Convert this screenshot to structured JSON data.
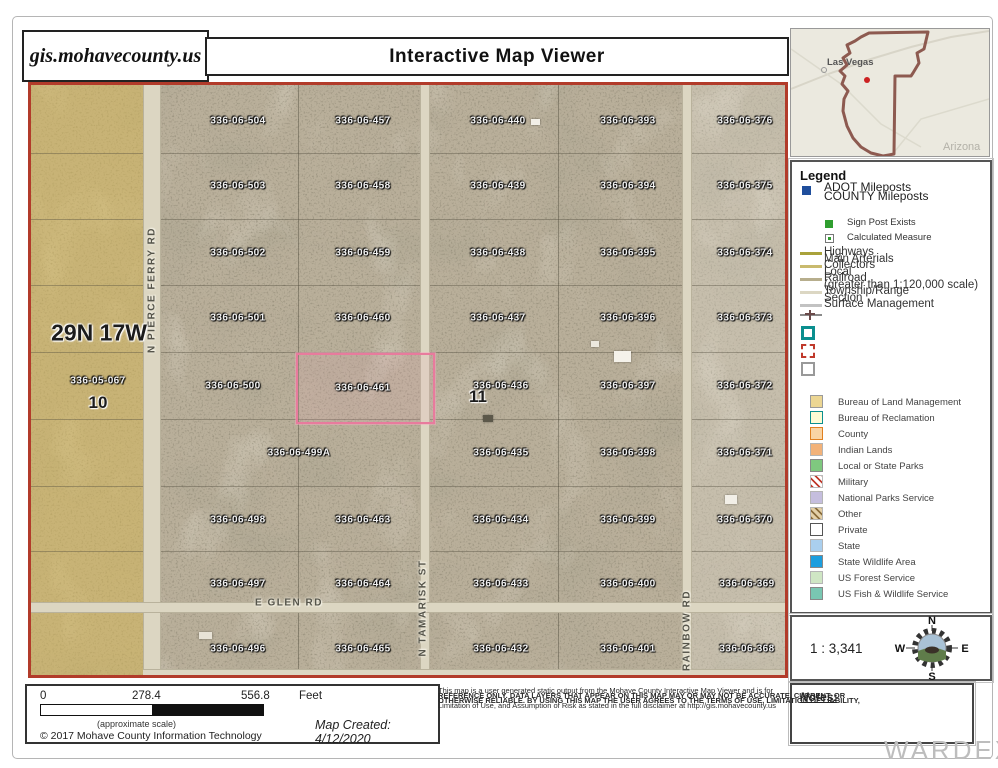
{
  "header": {
    "site": "gis.mohavecounty.us",
    "title": "Interactive Map Viewer"
  },
  "overview_map": {
    "city_label": "Las Vegas",
    "state_label": "Arizona",
    "outline_color": "#8d5a50",
    "marker_color": "#cc2222"
  },
  "map": {
    "township_label": "29N 17W",
    "left_parcel": {
      "label": "336-05-067",
      "x": 67,
      "y": 296
    },
    "sections": [
      {
        "text": "10",
        "x": 67,
        "y": 318
      },
      {
        "text": "11",
        "x": 447,
        "y": 312
      }
    ],
    "selected_parcel": {
      "label": "336-06-461",
      "x": 332,
      "y": 303,
      "rect": {
        "left": 265,
        "top": 268,
        "width": 135,
        "height": 67
      },
      "color": "#e87b9d"
    },
    "parcels": [
      {
        "label": "336-06-504",
        "x": 207,
        "y": 36
      },
      {
        "label": "336-06-457",
        "x": 332,
        "y": 36
      },
      {
        "label": "336-06-440",
        "x": 467,
        "y": 36
      },
      {
        "label": "336-06-393",
        "x": 597,
        "y": 36
      },
      {
        "label": "336-06-376",
        "x": 714,
        "y": 36
      },
      {
        "label": "336-06-503",
        "x": 207,
        "y": 101
      },
      {
        "label": "336-06-458",
        "x": 332,
        "y": 101
      },
      {
        "label": "336-06-439",
        "x": 467,
        "y": 101
      },
      {
        "label": "336-06-394",
        "x": 597,
        "y": 101
      },
      {
        "label": "336-06-375",
        "x": 714,
        "y": 101
      },
      {
        "label": "336-06-502",
        "x": 207,
        "y": 168
      },
      {
        "label": "336-06-459",
        "x": 332,
        "y": 168
      },
      {
        "label": "336-06-438",
        "x": 467,
        "y": 168
      },
      {
        "label": "336-06-395",
        "x": 597,
        "y": 168
      },
      {
        "label": "336-06-374",
        "x": 714,
        "y": 168
      },
      {
        "label": "336-06-501",
        "x": 207,
        "y": 233
      },
      {
        "label": "336-06-460",
        "x": 332,
        "y": 233
      },
      {
        "label": "336-06-437",
        "x": 467,
        "y": 233
      },
      {
        "label": "336-06-396",
        "x": 597,
        "y": 233
      },
      {
        "label": "336-06-373",
        "x": 714,
        "y": 233
      },
      {
        "label": "336-06-500",
        "x": 202,
        "y": 301
      },
      {
        "label": "336-06-436",
        "x": 470,
        "y": 301
      },
      {
        "label": "336-06-397",
        "x": 597,
        "y": 301
      },
      {
        "label": "336-06-372",
        "x": 714,
        "y": 301
      },
      {
        "label": "336-06-499A",
        "x": 268,
        "y": 368
      },
      {
        "label": "336-06-435",
        "x": 470,
        "y": 368
      },
      {
        "label": "336-06-398",
        "x": 597,
        "y": 368
      },
      {
        "label": "336-06-371",
        "x": 714,
        "y": 368
      },
      {
        "label": "336-06-498",
        "x": 207,
        "y": 435
      },
      {
        "label": "336-06-463",
        "x": 332,
        "y": 435
      },
      {
        "label": "336-06-434",
        "x": 470,
        "y": 435
      },
      {
        "label": "336-06-399",
        "x": 597,
        "y": 435
      },
      {
        "label": "336-06-370",
        "x": 714,
        "y": 435
      },
      {
        "label": "336-06-497",
        "x": 207,
        "y": 499
      },
      {
        "label": "336-06-464",
        "x": 332,
        "y": 499
      },
      {
        "label": "336-06-433",
        "x": 470,
        "y": 499
      },
      {
        "label": "336-06-400",
        "x": 597,
        "y": 499
      },
      {
        "label": "336-06-369",
        "x": 716,
        "y": 499
      },
      {
        "label": "336-06-496",
        "x": 207,
        "y": 564
      },
      {
        "label": "336-06-465",
        "x": 332,
        "y": 564
      },
      {
        "label": "336-06-432",
        "x": 470,
        "y": 564
      },
      {
        "label": "336-06-401",
        "x": 597,
        "y": 564
      },
      {
        "label": "336-06-368",
        "x": 716,
        "y": 564
      }
    ],
    "roads": [
      {
        "name": "N PIERCE FERRY RD",
        "orient": "v",
        "x": 121,
        "y": 205
      },
      {
        "name": "N TAMARISK ST",
        "orient": "v",
        "x": 392,
        "y": 523
      },
      {
        "name": "N RAINBOW RD",
        "orient": "v",
        "x": 656,
        "y": 552
      },
      {
        "name": "E GLEN RD",
        "orient": "h",
        "x": 258,
        "y": 518
      }
    ],
    "structures": [
      {
        "x": 500,
        "y": 34,
        "w": 9,
        "h": 6,
        "color": "#f2efe7"
      },
      {
        "x": 560,
        "y": 256,
        "w": 8,
        "h": 6,
        "color": "#ece8de"
      },
      {
        "x": 583,
        "y": 266,
        "w": 17,
        "h": 11,
        "color": "#f5f2ea"
      },
      {
        "x": 452,
        "y": 330,
        "w": 10,
        "h": 7,
        "color": "#5c584a"
      },
      {
        "x": 694,
        "y": 410,
        "w": 12,
        "h": 9,
        "color": "#f2efe7"
      },
      {
        "x": 168,
        "y": 547,
        "w": 13,
        "h": 7,
        "color": "#e8e3d6"
      }
    ]
  },
  "legend": {
    "title": "Legend",
    "milepost_items": [
      "ADOT Mileposts",
      "COUNTY Mileposts"
    ],
    "milepost_color": "#1f4e9c",
    "milepost_subitems": [
      "Sign Post Exists",
      "Calculated Measure"
    ],
    "signpost_color": "#2f9e2f",
    "line_items": [
      {
        "label": "Highways",
        "color": "#a9a23b"
      },
      {
        "label": "Main Arterials",
        "color": "#c9ba6e"
      },
      {
        "label": "Collectors",
        "color": "#b7ae8d"
      },
      {
        "label": "Local",
        "color": "#dcd7c3"
      },
      {
        "label": "Railroad",
        "color": "#c2c2c2"
      },
      {
        "label": "(greater than 1:120,000 scale)",
        "color": ""
      },
      {
        "label": "Township/Range",
        "color": ""
      },
      {
        "label": "Section",
        "color": ""
      },
      {
        "label": "Surface Management",
        "color": ""
      }
    ],
    "township_swatch_color": "#0b8f8f",
    "section_swatch_color": "#c0392b",
    "surface_categories": [
      {
        "label": "Bureau of Land Management",
        "fill": "#ecd693",
        "border": "#9a9a9a",
        "hatch": ""
      },
      {
        "label": "Bureau of Reclamation",
        "fill": "#fdfbd4",
        "border": "#0b8f8f",
        "hatch": ""
      },
      {
        "label": "County",
        "fill": "#f9d4a4",
        "border": "#e08020",
        "hatch": ""
      },
      {
        "label": "Indian Lands",
        "fill": "#f2b279",
        "border": "#b5b5b5",
        "hatch": ""
      },
      {
        "label": "Local or State Parks",
        "fill": "#7fc87f",
        "border": "#888888",
        "hatch": ""
      },
      {
        "label": "Military",
        "fill": "#ffffff",
        "border": "#bbbbbb",
        "hatch": "#c0392b"
      },
      {
        "label": "National Parks Service",
        "fill": "#c5bede",
        "border": "#b5b5b5",
        "hatch": ""
      },
      {
        "label": "Other",
        "fill": "#e3d0a8",
        "border": "#b5b5b5",
        "hatch": "#8a6d3b"
      },
      {
        "label": "Private",
        "fill": "#ffffff",
        "border": "#555555",
        "hatch": ""
      },
      {
        "label": "State",
        "fill": "#aacfee",
        "border": "#b5b5b5",
        "hatch": ""
      },
      {
        "label": "State Wildlife Area",
        "fill": "#1c9ede",
        "border": "#888888",
        "hatch": ""
      },
      {
        "label": "US Forest Service",
        "fill": "#cfe6c4",
        "border": "#b5b5b5",
        "hatch": ""
      },
      {
        "label": "US Fish & Wildlife Service",
        "fill": "#79c7b2",
        "border": "#888888",
        "hatch": ""
      }
    ]
  },
  "scale_panel": {
    "ratio": "1 : 3,341",
    "compass": {
      "n": "N",
      "e": "E",
      "s": "S",
      "w": "W"
    }
  },
  "notes": {
    "label": "Notes:"
  },
  "footer": {
    "scale_bar": {
      "start": "0",
      "mid": "278.4",
      "end": "556.8",
      "unit": "Feet",
      "caption": "(approximate scale)"
    },
    "copyright": "© 2017 Mohave County Information Technology",
    "map_created": "Map Created: 4/12/2020",
    "disclaimer_lines": [
      "This map is a user generated static output from the Mohave County Interactive Map Viewer and is for",
      "REFERENCE ONLY. DATA LAYERS THAT APPEAR ON THIS MAP MAY OR MAY NOT BE ACCURATE, CURRENT, OR",
      "OTHERWISE RELIABLE. BY USING THIS MAP THE USER AGREES TO THE TERMS OF USE, LIMITATION OF LIABILITY,",
      "Limitation of Use, and Assumption of Risk as stated in the full disclaimer at http://gis.mohavecounty.us"
    ]
  },
  "watermark": "WARDEX"
}
